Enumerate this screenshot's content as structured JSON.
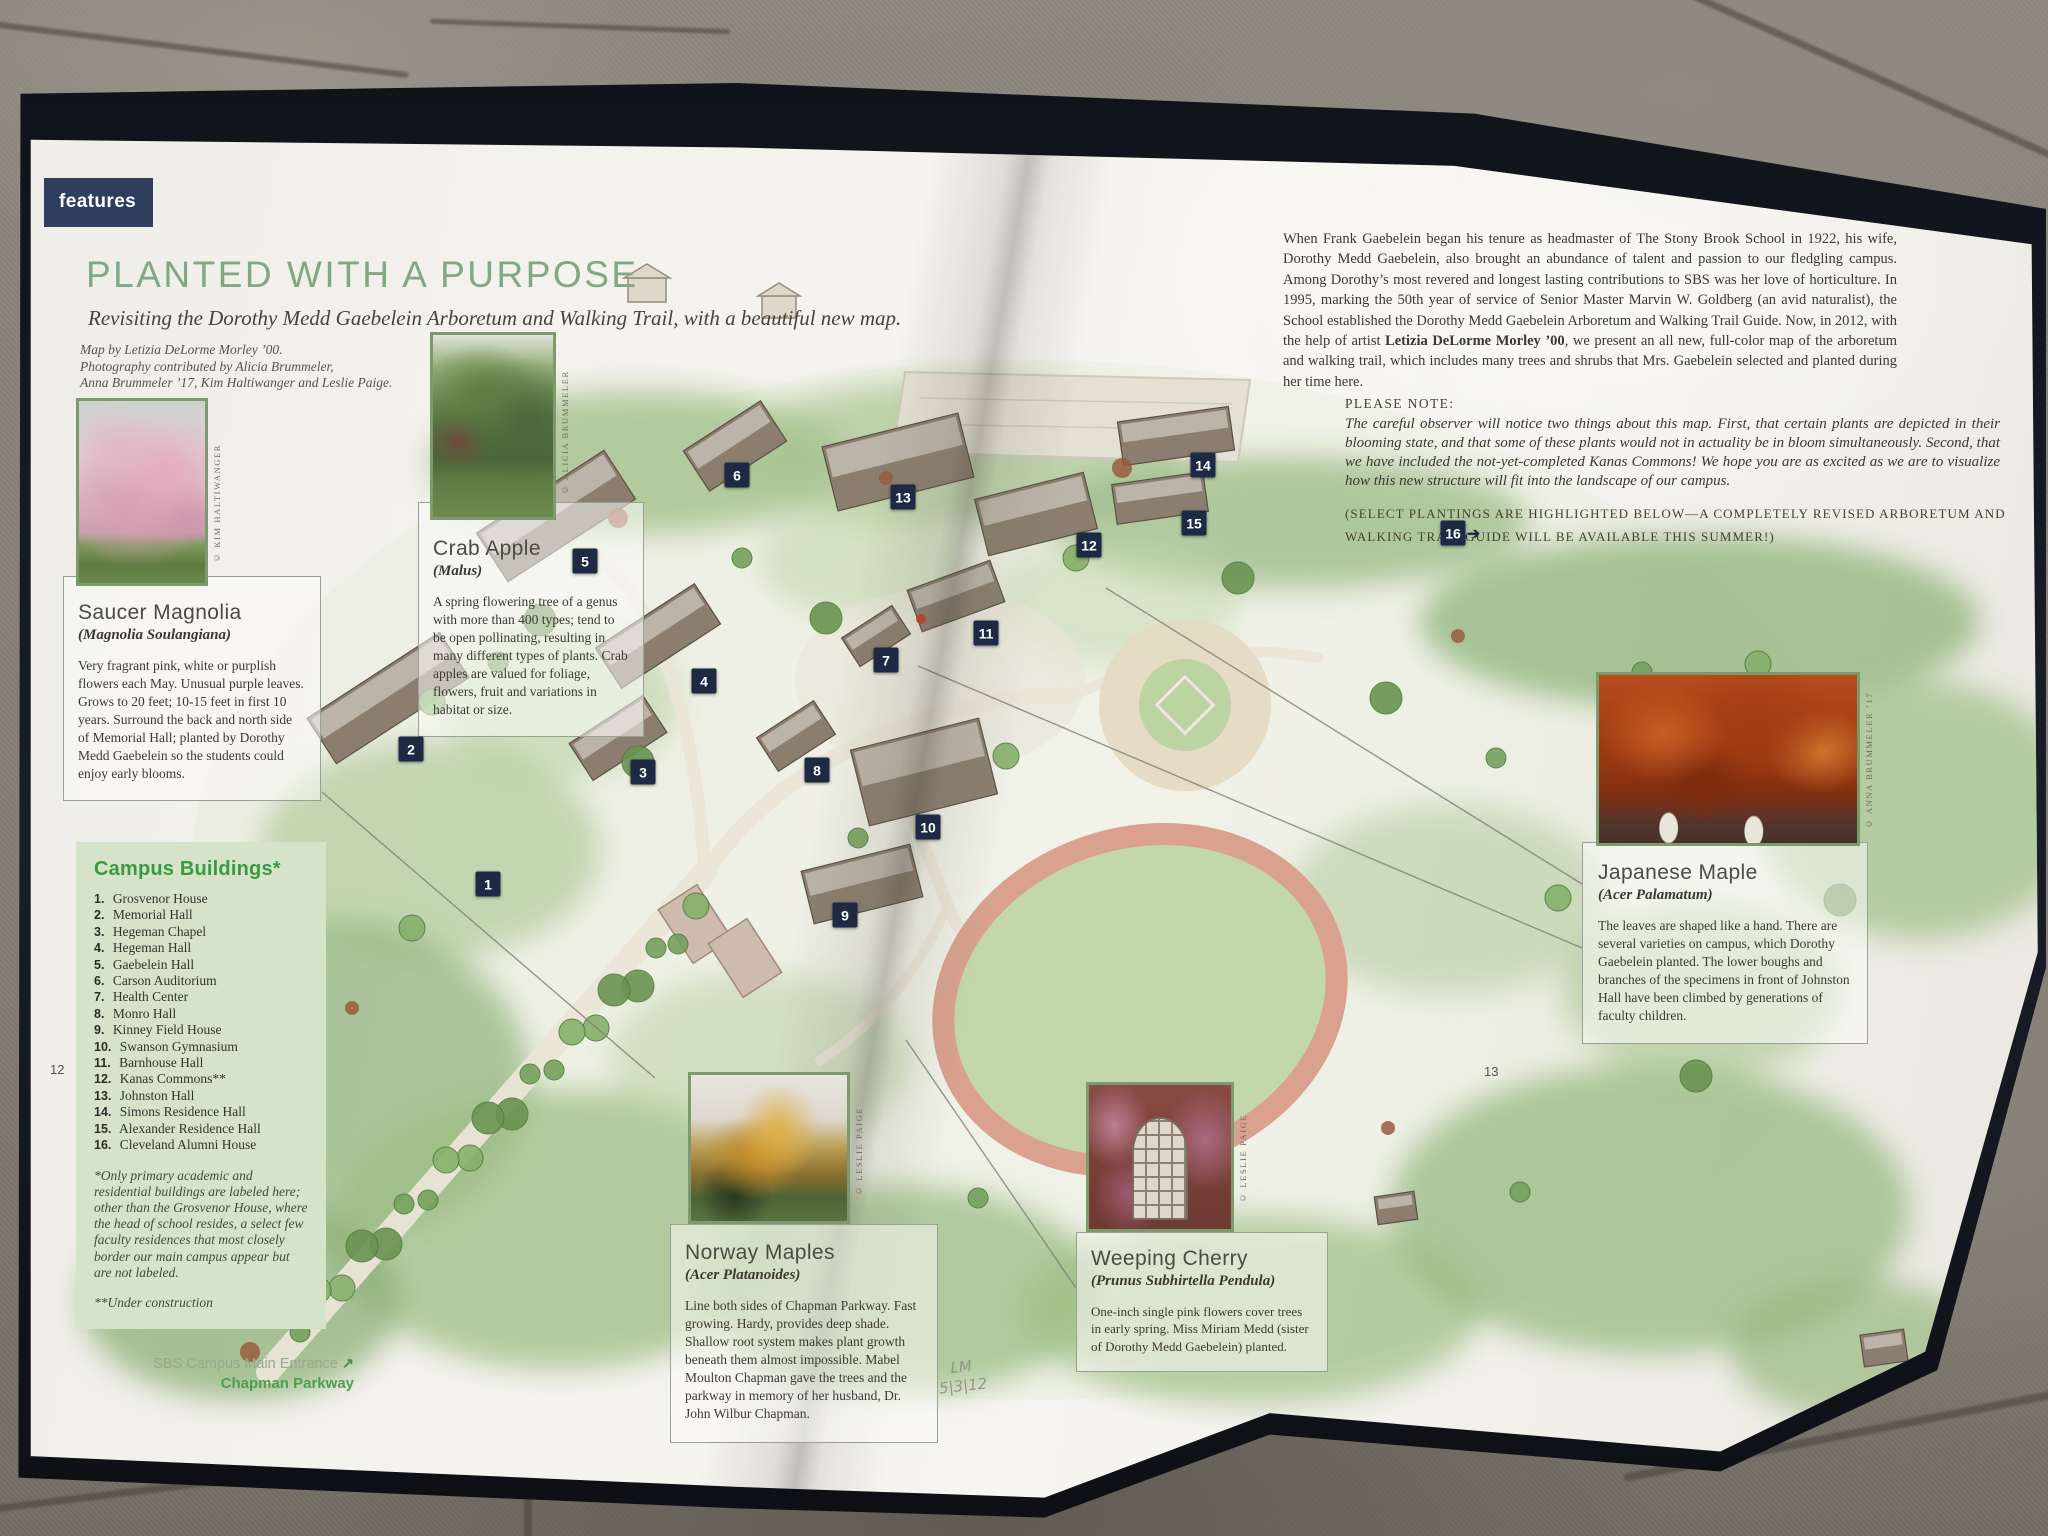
{
  "magazine": {
    "features_tag": "features",
    "title": "PLANTED WITH A PURPOSE",
    "subtitle": "Revisiting the Dorothy Medd Gaebelein Arboretum and Walking Trail, with a beautiful new map.",
    "credit_lines": [
      "Map by Letizia DeLorme Morley ’00.",
      "Photography contributed by Alicia Brummeler,",
      "Anna Brummeler ’17, Kim Haltiwanger and Leslie Paige."
    ],
    "left_page_number": "12",
    "right_page_number": "13",
    "intro": {
      "before": "When Frank Gaebelein began his tenure as headmaster of The Stony Brook School in 1922, his wife, Dorothy Medd Gaebelein, also brought an abundance of talent and passion to our fledgling campus. Among Dorothy’s most revered and longest lasting contributions to SBS was her love of horticulture. In 1995, marking the 50th year of service of Senior Master Marvin W. Goldberg (an avid naturalist), the School established the Dorothy Medd Gaebelein Arboretum and Walking Trail Guide. Now, in 2012, with the help of artist ",
      "bold": "Letizia DeLorme Morley ’00",
      "after": ", we present an all new, full-color map of the arboretum and walking trail, which includes many trees and shrubs that Mrs. Gaebelein selected and planted during her time here."
    },
    "note": {
      "label": "PLEASE NOTE:",
      "text": "The careful observer will notice two things about this map.  First, that certain plants are depicted in their blooming state, and that some of these plants would not in actuality be in bloom simultaneously. Second, that we have included the not-yet-completed Kanas Commons!  We hope you are as excited as we are to visualize how this new structure will fit into the landscape of our campus."
    },
    "select_note": "(SELECT PLANTINGS ARE HIGHLIGHTED BELOW—A COMPLETELY REVISED ARBORETUM AND WALKING TRAIL GUIDE WILL BE AVAILABLE THIS SUMMER!)",
    "campus_buildings": {
      "title": "Campus Buildings*",
      "items": [
        "Grosvenor House",
        "Memorial Hall",
        "Hegeman Chapel",
        "Hegeman Hall",
        "Gaebelein Hall",
        "Carson Auditorium",
        "Health Center",
        "Monro Hall",
        "Kinney Field House",
        "Swanson Gymnasium",
        "Barnhouse Hall",
        "Kanas Commons**",
        "Johnston Hall",
        "Simons Residence Hall",
        "Alexander Residence Hall",
        "Cleveland Alumni House"
      ],
      "footnote_primary": "*Only primary academic and residential buildings are labeled here; other than the Grosvenor House, where the head of school resides, a select few faculty residences that most closely border our main campus appear but are not labeled.",
      "footnote_construction": "**Under construction"
    },
    "plants": {
      "saucer_magnolia": {
        "name": "Saucer Magnolia",
        "species": "(Magnolia Soulangiana)",
        "description": "Very fragrant pink, white or purplish flowers each May. Unusual purple leaves. Grows to 20 feet; 10-15 feet in first 10 years.  Surround the back and north side of Memorial Hall; planted by Dorothy Medd Gaebelein so the students could enjoy early blooms.",
        "photo_credit": "© KIM HALTIWANGER"
      },
      "crab_apple": {
        "name": "Crab Apple",
        "species": "(Malus)",
        "description": "A spring flowering tree of a genus with more than 400 types; tend to be open pollinating, resulting in many different types of plants. Crab apples are valued for foliage, flowers, fruit and variations in habitat or size.",
        "photo_credit": "© ALICIA BRUMMELER"
      },
      "japanese_maple": {
        "name": "Japanese Maple",
        "species": "(Acer Palamatum)",
        "description": "The leaves are shaped like a hand. There are several varieties on campus, which Dorothy Gaebelein planted. The lower boughs and branches of the specimens in front of Johnston Hall have been climbed by generations of faculty children.",
        "photo_credit": "© ANNA BRUMMELER ’17"
      },
      "norway_maples": {
        "name": "Norway Maples",
        "species": "(Acer Platanoides)",
        "description": "Line both sides of Chapman Parkway. Fast growing. Hardy, provides deep shade. Shallow root system makes plant growth beneath them almost impossible. Mabel Moulton Chapman gave the trees and the parkway in memory of her husband, Dr. John Wilbur Chapman.",
        "photo_credit": "© LESLIE PAIGE"
      },
      "weeping_cherry": {
        "name": "Weeping Cherry",
        "species": "(Prunus Subhirtella Pendula)",
        "description": "One-inch single pink flowers cover trees in early spring. Miss Miriam Medd (sister of Dorothy Medd Gaebelein) planted.",
        "photo_credit": "© LESLIE PAIGE"
      }
    },
    "entrance": {
      "label": "SBS Campus Main Entrance",
      "arrow": "↗",
      "road": "Chapman Parkway"
    },
    "handwriting": {
      "line1": "LM",
      "line2": "5|3|12"
    },
    "map_markers": [
      {
        "label": "1",
        "x": 488,
        "y": 884
      },
      {
        "label": "2",
        "x": 411,
        "y": 749
      },
      {
        "label": "3",
        "x": 643,
        "y": 772
      },
      {
        "label": "4",
        "x": 704,
        "y": 681
      },
      {
        "label": "5",
        "x": 585,
        "y": 561
      },
      {
        "label": "6",
        "x": 737,
        "y": 475
      },
      {
        "label": "7",
        "x": 886,
        "y": 660
      },
      {
        "label": "8",
        "x": 817,
        "y": 770
      },
      {
        "label": "9",
        "x": 845,
        "y": 915
      },
      {
        "label": "10",
        "x": 928,
        "y": 827
      },
      {
        "label": "11",
        "x": 986,
        "y": 633
      },
      {
        "label": "12",
        "x": 1089,
        "y": 545
      },
      {
        "label": "13",
        "x": 903,
        "y": 497
      },
      {
        "label": "14",
        "x": 1203,
        "y": 465
      },
      {
        "label": "15",
        "x": 1194,
        "y": 523
      },
      {
        "label": "16",
        "x": 1453,
        "y": 533,
        "arrow": "➔"
      }
    ],
    "colors": {
      "accent_green": "#80a983",
      "tag_navy": "#2f3e5c",
      "marker_navy": "#1e2a44",
      "list_header_green": "#3a9a41",
      "campus_box_bg": "#d5e4c9"
    }
  }
}
